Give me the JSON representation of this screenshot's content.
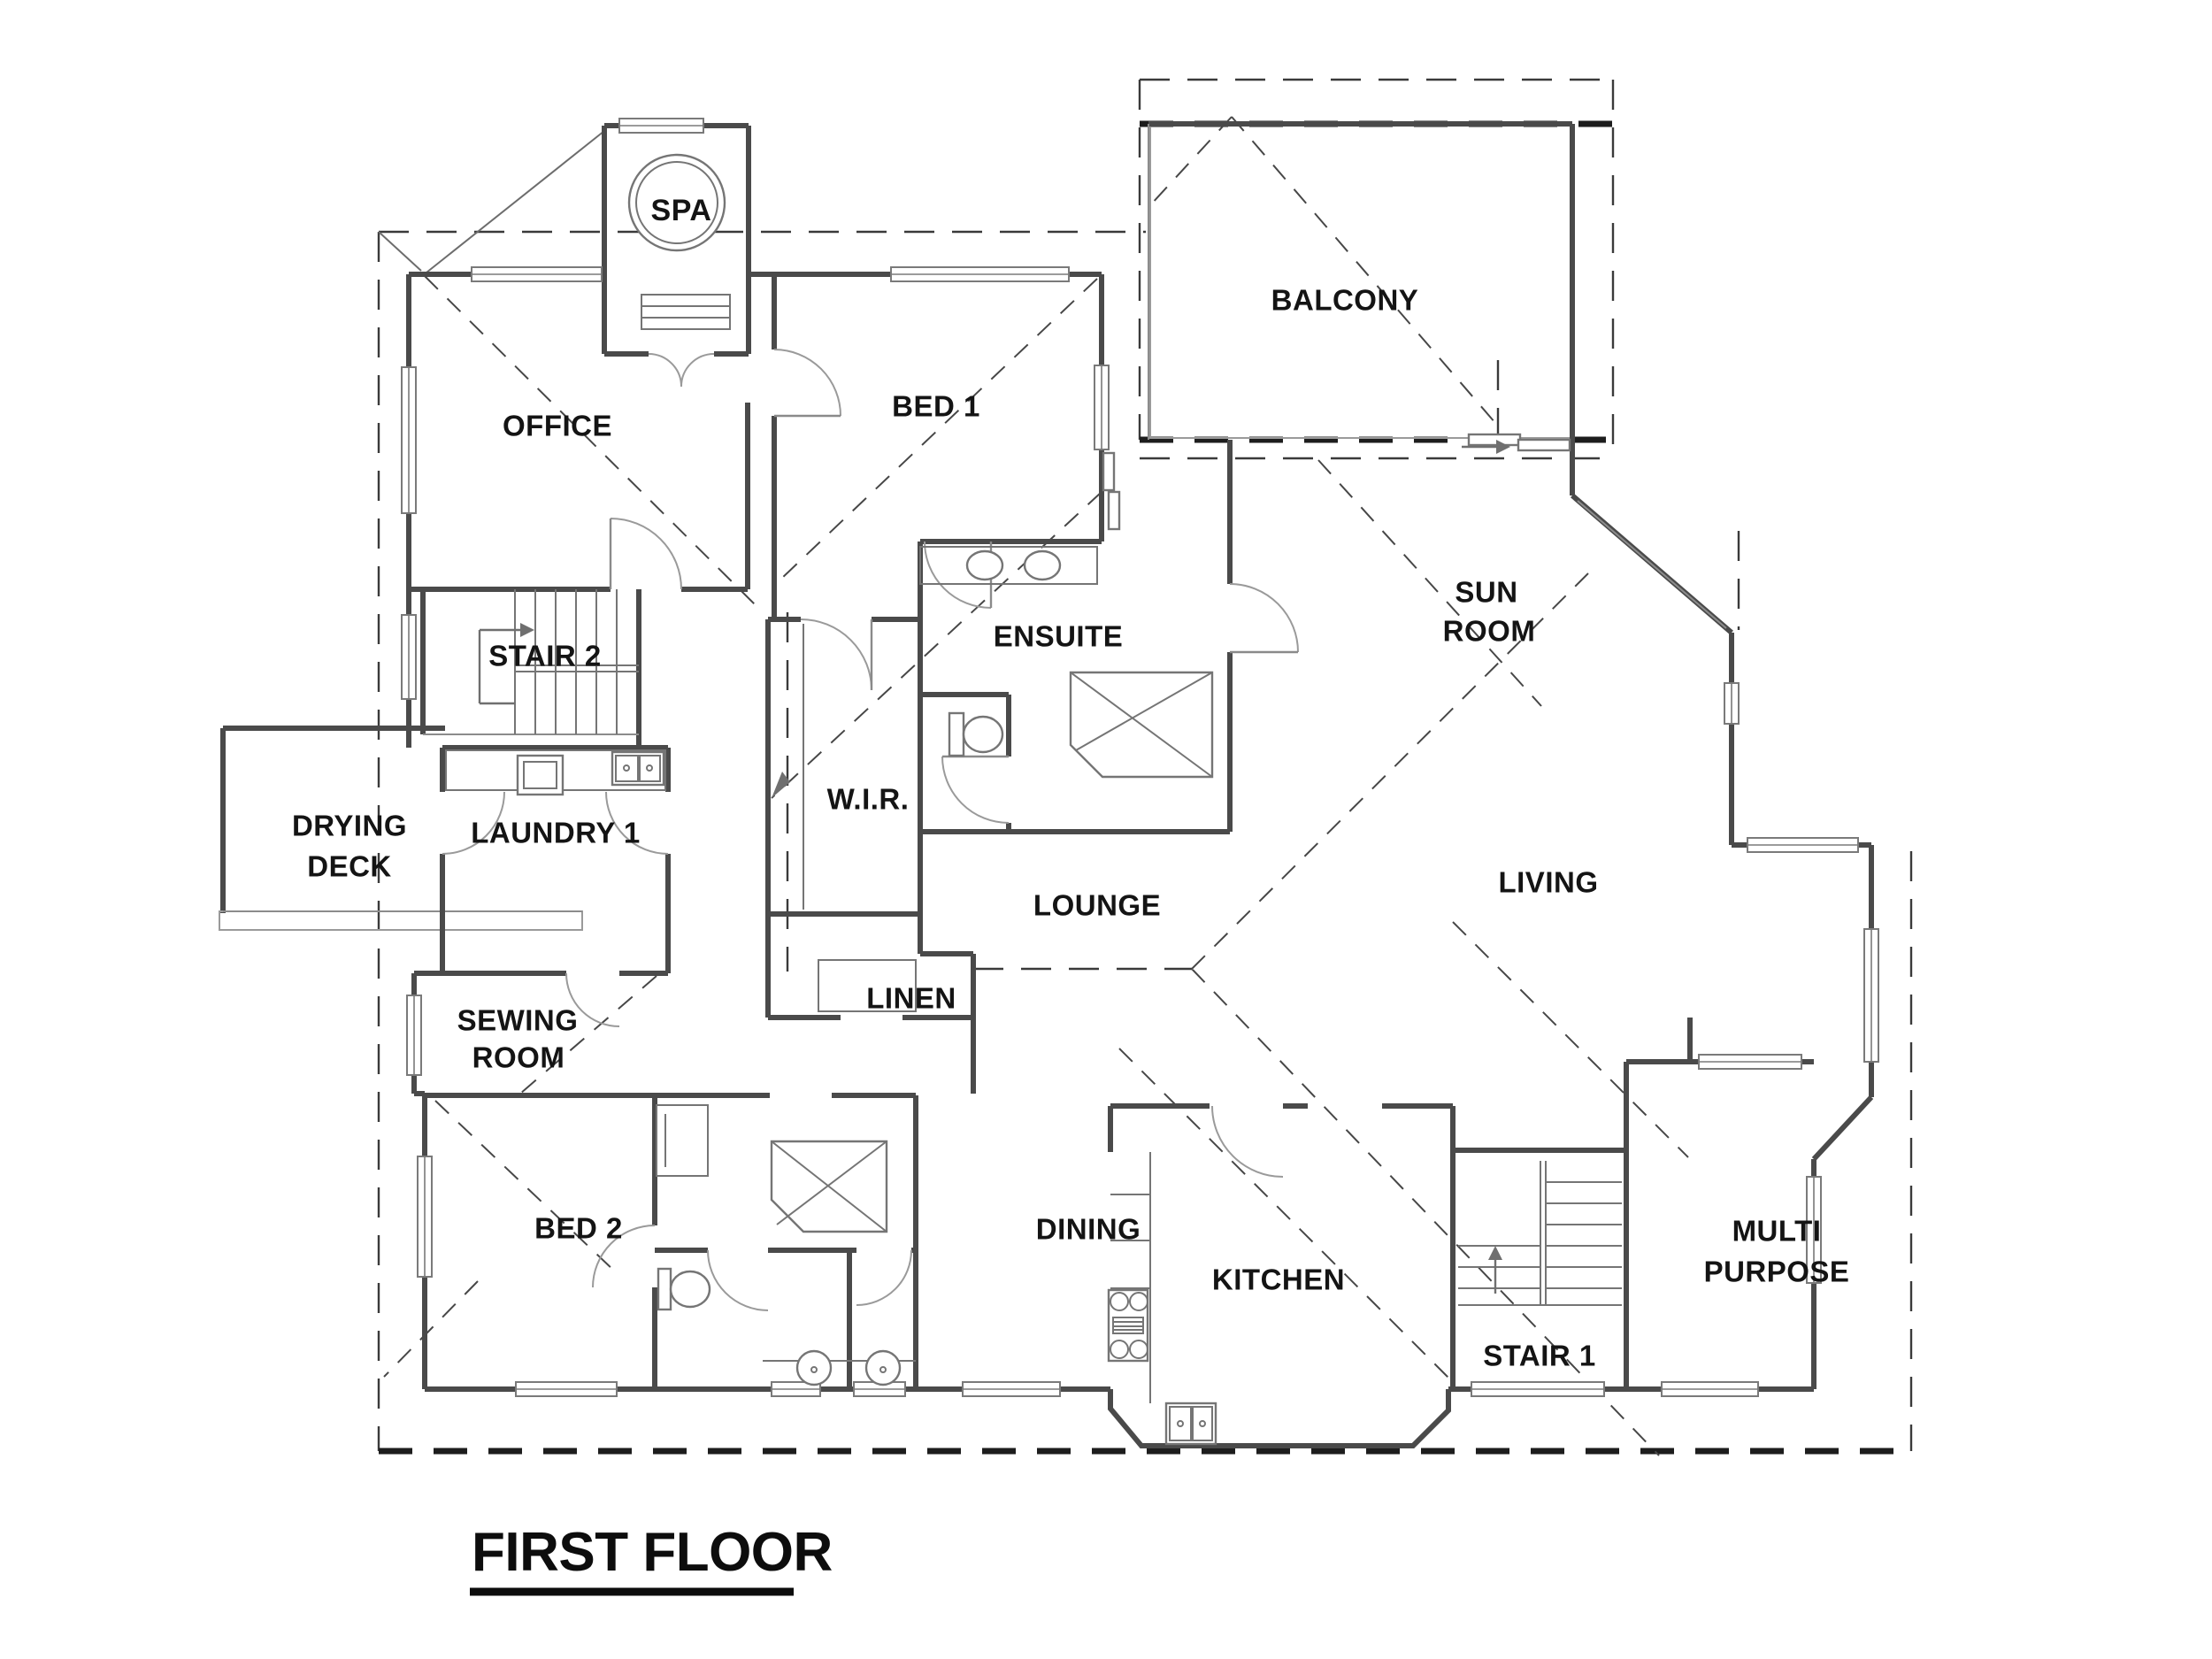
{
  "title": "FIRST FLOOR",
  "drawing_type": "architectural floor plan",
  "colors": {
    "background": "#ffffff",
    "wall_line": "#4a4a4a",
    "dashed_roof_line": "#3a3a3a",
    "heavy_hidden_line": "#1d1d1d",
    "fixture_line": "#757575",
    "hatch_line": "#ababab",
    "label_text": "#141414"
  },
  "rooms": {
    "spa": {
      "label": "SPA"
    },
    "office": {
      "label": "OFFICE"
    },
    "bed1": {
      "label": "BED 1"
    },
    "balcony": {
      "label": "BALCONY"
    },
    "ensuite": {
      "label": "ENSUITE"
    },
    "sunroom": {
      "line1": "SUN",
      "line2": "ROOM"
    },
    "stair2": {
      "label": "STAIR 2"
    },
    "drying_deck": {
      "line1": "DRYING",
      "line2": "DECK"
    },
    "laundry1": {
      "label": "LAUNDRY 1"
    },
    "wir": {
      "label": "W.I.R."
    },
    "lounge": {
      "label": "LOUNGE"
    },
    "linen": {
      "label": "LINEN"
    },
    "living": {
      "label": "LIVING"
    },
    "sewing": {
      "line1": "SEWING",
      "line2": "ROOM"
    },
    "bed2": {
      "label": "BED 2"
    },
    "dining": {
      "label": "DINING"
    },
    "kitchen": {
      "label": "KITCHEN"
    },
    "stair1": {
      "label": "STAIR 1"
    },
    "multipurpose": {
      "line1": "MULTI",
      "line2": "PURPOSE"
    }
  },
  "icons": {
    "spa_tub": "spa-tub-icon",
    "double_sink": "double-sink-icon",
    "washing_machine": "washing-machine-icon",
    "vanity_basin": "basin-icon",
    "toilet": "toilet-icon",
    "shower": "shower-icon",
    "cooktop": "cooktop-icon",
    "kitchen_sink": "kitchen-sink-icon",
    "stair_treads": "stair-treads-icon",
    "direction_arrow": "direction-arrow-icon"
  }
}
